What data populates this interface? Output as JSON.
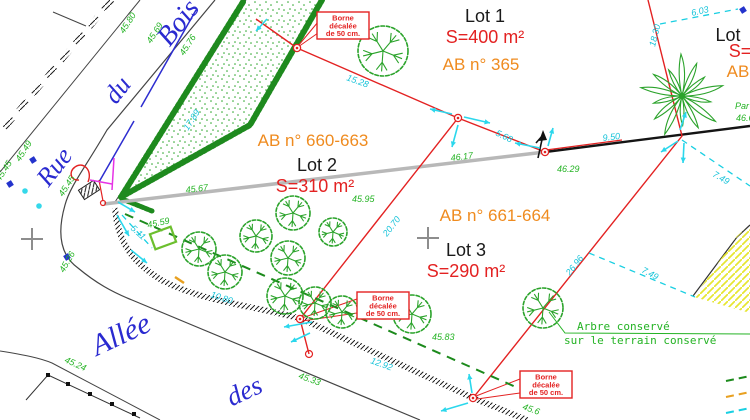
{
  "plan_title": "Plan de division - lotissement",
  "colors": {
    "red": "#e32222",
    "orange": "#ef8b1f",
    "green_text": "#24b324",
    "cyan": "#17c3d9",
    "cyan_arrow": "#2bd7ec",
    "blue_street": "#2a2ad0",
    "tree_green": "#2ba32b",
    "hedge_green": "#1e8a1e",
    "gray_line": "#b8b8b8",
    "magenta": "#e633e6",
    "yellow_hatch": "#e6e630"
  },
  "streets": [
    {
      "label": "Rue",
      "x": 61,
      "y": 172,
      "rot": -52,
      "size": 26
    },
    {
      "label": "du",
      "x": 124,
      "y": 95,
      "rot": -52,
      "size": 26
    },
    {
      "label": "Bois",
      "x": 185,
      "y": 28,
      "rot": -52,
      "size": 28
    },
    {
      "label": "Allée",
      "x": 125,
      "y": 343,
      "rot": -25,
      "size": 30
    },
    {
      "label": "des",
      "x": 248,
      "y": 399,
      "rot": -25,
      "size": 27
    }
  ],
  "lots": [
    {
      "name": "Lot 1",
      "area": "S=400 m²",
      "parcel": "AB n° 365",
      "name_xy": [
        485,
        22
      ],
      "area_xy": [
        485,
        43
      ],
      "parcel_xy": [
        481,
        70
      ]
    },
    {
      "name": "Lot 2",
      "area": "S=310 m²",
      "parcel": "AB n° 660-663",
      "name_xy": [
        317,
        171
      ],
      "area_xy": [
        315,
        192
      ],
      "parcel_xy": [
        313,
        146
      ]
    },
    {
      "name": "Lot 3",
      "area": "S=290 m²",
      "parcel": "AB n° 661-664",
      "name_xy": [
        466,
        256
      ],
      "area_xy": [
        466,
        277
      ],
      "parcel_xy": [
        495,
        221
      ]
    },
    {
      "name": "Lot",
      "area": "S=",
      "parcel": "AB",
      "name_xy": [
        728,
        41
      ],
      "area_xy": [
        740,
        57
      ],
      "parcel_xy": [
        738,
        77
      ]
    }
  ],
  "borne_label": [
    "Borne",
    "décalée",
    "de 50 cm."
  ],
  "borne_boxes": [
    [
      317,
      12
    ],
    [
      357,
      292
    ],
    [
      520,
      371
    ]
  ],
  "tree_note": {
    "line1": "Arbre conservé",
    "line2": "sur le terrain conservé",
    "x1": 577,
    "y1": 330,
    "x2": 564,
    "y2": 344
  },
  "dimensions_cyan": [
    {
      "t": "15.28",
      "x": 346,
      "y": 80,
      "r": 20
    },
    {
      "t": "5.68",
      "x": 495,
      "y": 135,
      "r": 26
    },
    {
      "t": "9.50",
      "x": 603,
      "y": 141,
      "r": -7
    },
    {
      "t": "6.03",
      "x": 692,
      "y": 16,
      "r": -13
    },
    {
      "t": "18.30",
      "x": 655,
      "y": 47,
      "r": -76
    },
    {
      "t": "7.49",
      "x": 712,
      "y": 176,
      "r": 30
    },
    {
      "t": "7.49",
      "x": 641,
      "y": 272,
      "r": 28
    },
    {
      "t": "20.70",
      "x": 387,
      "y": 237,
      "r": -52
    },
    {
      "t": "26.96",
      "x": 570,
      "y": 276,
      "r": -52
    },
    {
      "t": "10.80",
      "x": 210,
      "y": 297,
      "r": 18
    },
    {
      "t": "12.92",
      "x": 370,
      "y": 363,
      "r": 20
    },
    {
      "t": "5.11",
      "x": 130,
      "y": 229,
      "r": 42
    },
    {
      "t": "17.89",
      "x": 188,
      "y": 131,
      "r": -57
    }
  ],
  "elevations_green": [
    {
      "t": "45.80",
      "x": 124,
      "y": 34,
      "r": -57
    },
    {
      "t": "45.69",
      "x": 151,
      "y": 44,
      "r": -57
    },
    {
      "t": "45.76",
      "x": 184,
      "y": 56,
      "r": -57
    },
    {
      "t": "45.49",
      "x": 20,
      "y": 162,
      "r": -57
    },
    {
      "t": "45.45",
      "x": 0,
      "y": 182,
      "r": -57
    },
    {
      "t": "45.45",
      "x": 63,
      "y": 197,
      "r": -57
    },
    {
      "t": "45.67",
      "x": 186,
      "y": 193,
      "r": -7
    },
    {
      "t": "45.59",
      "x": 148,
      "y": 228,
      "r": -12
    },
    {
      "t": "45.95",
      "x": 352,
      "y": 202,
      "r": 0
    },
    {
      "t": "46.17",
      "x": 451,
      "y": 161,
      "r": -7
    },
    {
      "t": "46.29",
      "x": 557,
      "y": 172,
      "r": 0
    },
    {
      "t": "45.83",
      "x": 432,
      "y": 340,
      "r": 0
    },
    {
      "t": "45.33",
      "x": 298,
      "y": 378,
      "r": 20
    },
    {
      "t": "45.24",
      "x": 64,
      "y": 362,
      "r": 24
    },
    {
      "t": "45.26",
      "x": 64,
      "y": 273,
      "r": -60
    },
    {
      "t": "45.6",
      "x": 522,
      "y": 409,
      "r": 20
    },
    {
      "t": "Par",
      "x": 735,
      "y": 109,
      "r": 0
    },
    {
      "t": "46.6",
      "x": 736,
      "y": 121,
      "r": 0
    }
  ],
  "trees_round": [
    [
      383,
      51,
      25
    ],
    [
      199,
      249,
      17
    ],
    [
      225,
      272,
      17
    ],
    [
      256,
      236,
      16
    ],
    [
      293,
      213,
      17
    ],
    [
      288,
      258,
      17
    ],
    [
      285,
      296,
      18
    ],
    [
      315,
      303,
      16
    ],
    [
      342,
      312,
      16
    ],
    [
      333,
      232,
      14
    ],
    [
      412,
      314,
      19
    ],
    [
      543,
      308,
      20
    ]
  ],
  "tree_palm": [
    682,
    96,
    42
  ],
  "survey_markers": [
    [
      297,
      48
    ],
    [
      458,
      118
    ],
    [
      545,
      152
    ],
    [
      300,
      319
    ],
    [
      473,
      398
    ]
  ],
  "open_markers": [
    [
      309,
      354,
      3.5
    ],
    [
      103,
      203,
      2.5
    ]
  ],
  "blue_squares": [
    [
      33,
      160
    ],
    [
      10,
      184
    ],
    [
      67,
      257
    ],
    [
      743,
      10
    ]
  ],
  "cyan_dots": [
    [
      25,
      191
    ],
    [
      39,
      206
    ]
  ],
  "gray_crosses": [
    [
      32,
      239
    ],
    [
      428,
      238
    ]
  ],
  "flow_arrows": [
    [
      452,
      114,
      430,
      109
    ],
    [
      464,
      117,
      490,
      123
    ],
    [
      458,
      125,
      452,
      147
    ],
    [
      540,
      148,
      515,
      143
    ],
    [
      548,
      146,
      553,
      128
    ],
    [
      680,
      130,
      686,
      112
    ],
    [
      678,
      141,
      661,
      152
    ],
    [
      684,
      143,
      683,
      163
    ],
    [
      118,
      202,
      135,
      212
    ],
    [
      117,
      215,
      129,
      236
    ],
    [
      131,
      250,
      147,
      263
    ],
    [
      312,
      322,
      284,
      327
    ],
    [
      310,
      333,
      291,
      342
    ],
    [
      468,
      403,
      441,
      411
    ],
    [
      472,
      393,
      469,
      374
    ],
    [
      267,
      19,
      256,
      31
    ]
  ]
}
